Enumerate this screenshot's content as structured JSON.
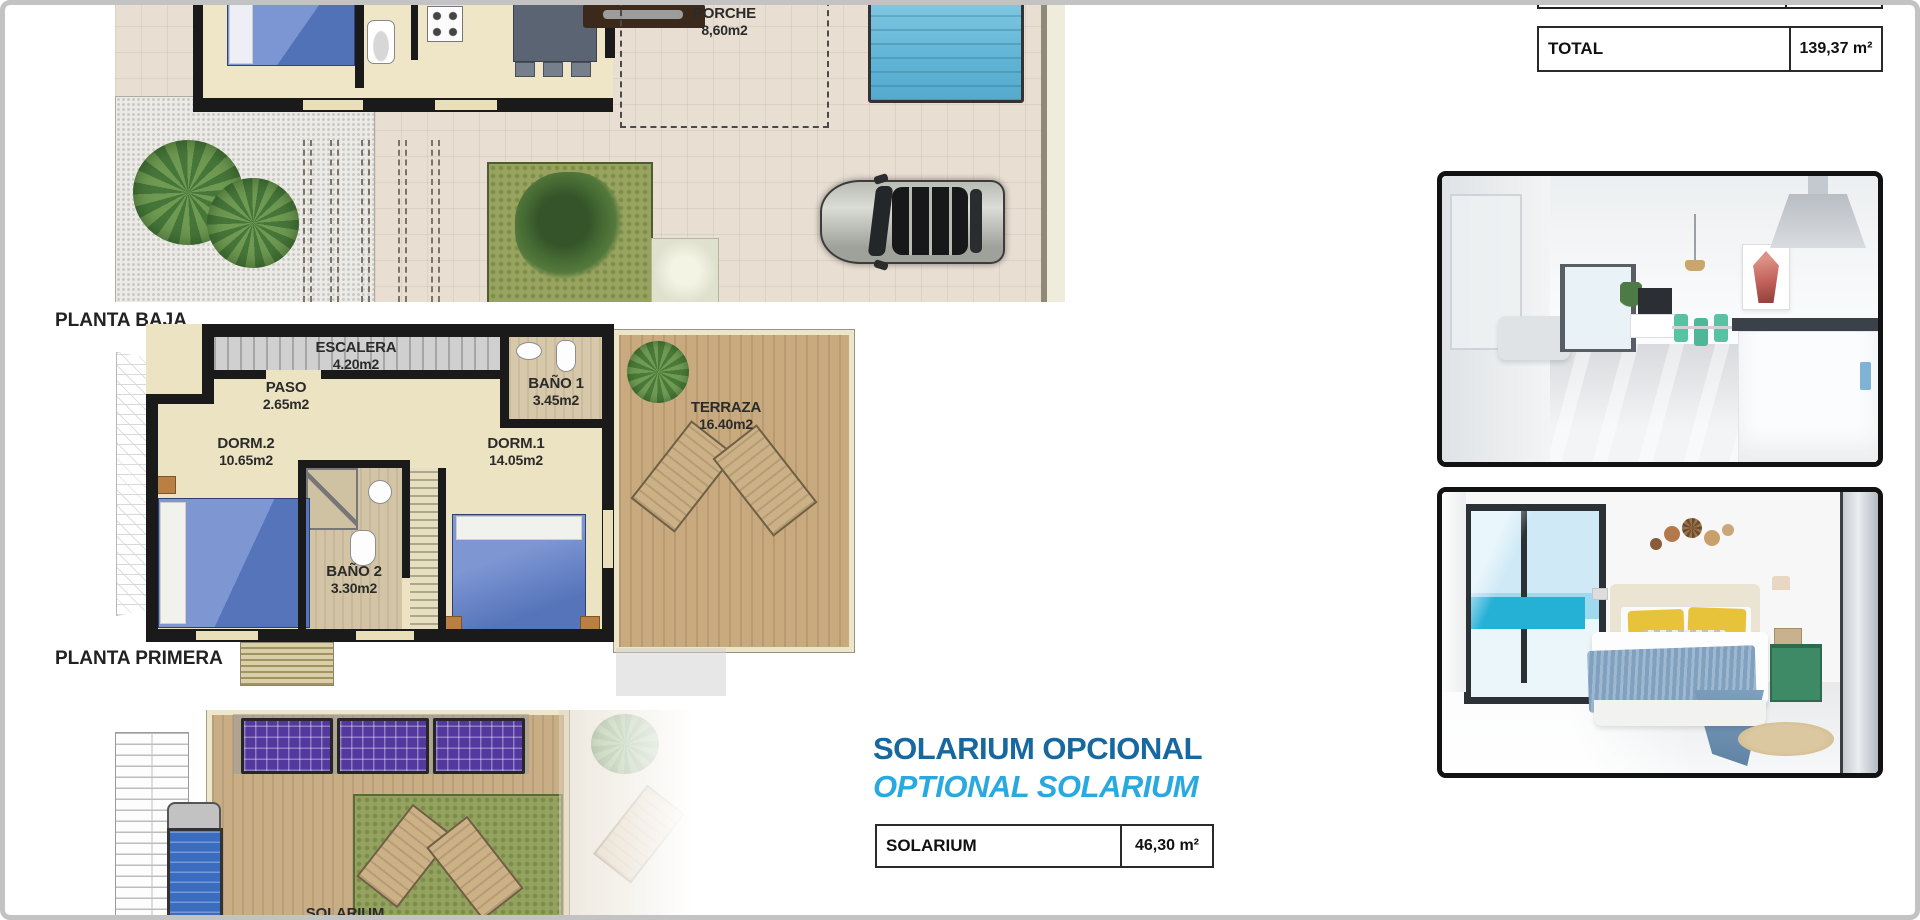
{
  "floor_labels": {
    "ground": "PLANTA BAJA",
    "first": "PLANTA PRIMERA"
  },
  "ground_floor": {
    "porche": {
      "name": "PORCHE",
      "area": "8,60m2"
    }
  },
  "first_floor": {
    "escalera": {
      "name": "ESCALERA",
      "area": "4.20m2"
    },
    "paso": {
      "name": "PASO",
      "area": "2.65m2"
    },
    "bano1": {
      "name": "BAÑO 1",
      "area": "3.45m2"
    },
    "terraza": {
      "name": "TERRAZA",
      "area": "16.40m2"
    },
    "dorm2": {
      "name": "DORM.2",
      "area": "10.65m2"
    },
    "bano2": {
      "name": "BAÑO 2",
      "area": "3.30m2"
    },
    "dorm1": {
      "name": "DORM.1",
      "area": "14.05m2"
    }
  },
  "solarium_floor": {
    "label": "SOLARIUM"
  },
  "solarium_section": {
    "title_es": "SOLARIUM OPCIONAL",
    "title_en": "OPTIONAL SOLARIUM",
    "table": {
      "label": "SOLARIUM",
      "value": "46,30 m²"
    }
  },
  "summary_table": {
    "label": "TOTAL",
    "value": "139,37 m²"
  },
  "colors": {
    "title_es": "#16689f",
    "title_en": "#29a9e0",
    "pool_water": "#5fb3d4",
    "bed_blue": "#5574ba",
    "solar_panel_purple": "#53389f",
    "deck_wood": "#c9ad85",
    "grass_green": "#93a35f",
    "wall_black": "#1a1a1a"
  }
}
